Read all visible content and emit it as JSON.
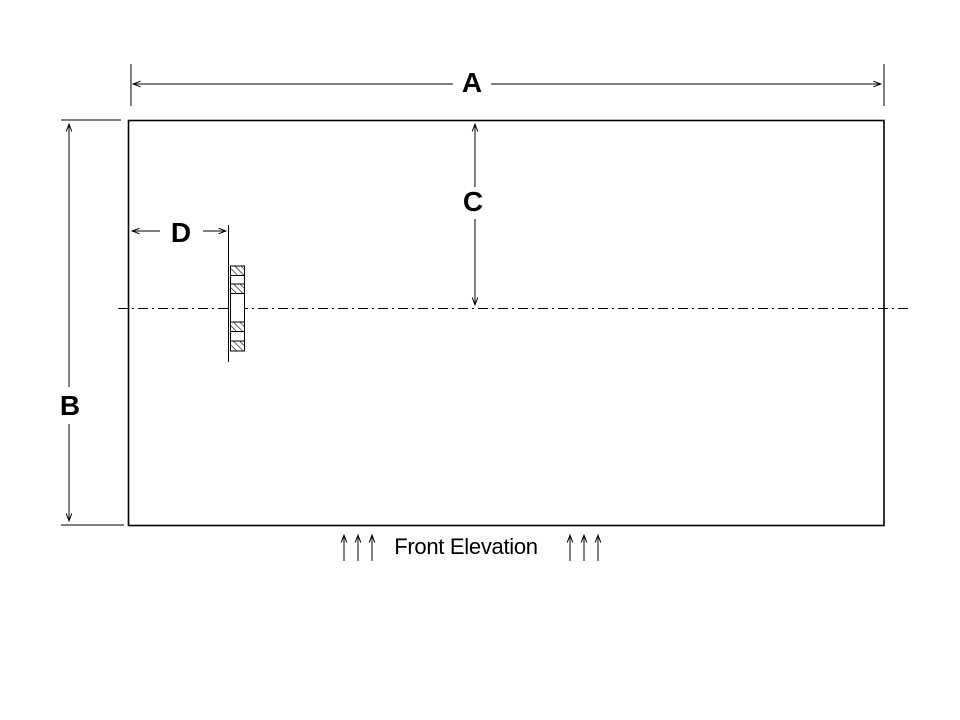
{
  "drawing": {
    "type": "technical-elevation-drawing",
    "caption": "Front Elevation",
    "dimension_labels": {
      "a": "A",
      "b": "B",
      "c": "C",
      "d": "D"
    },
    "features": {
      "outline": "rectangular tank front elevation",
      "centerline": "horizontal dash-dot centerline",
      "nozzle": "hatched flange cross-section near left side"
    },
    "colors": {
      "line": "#000000",
      "background": "#ffffff"
    }
  }
}
